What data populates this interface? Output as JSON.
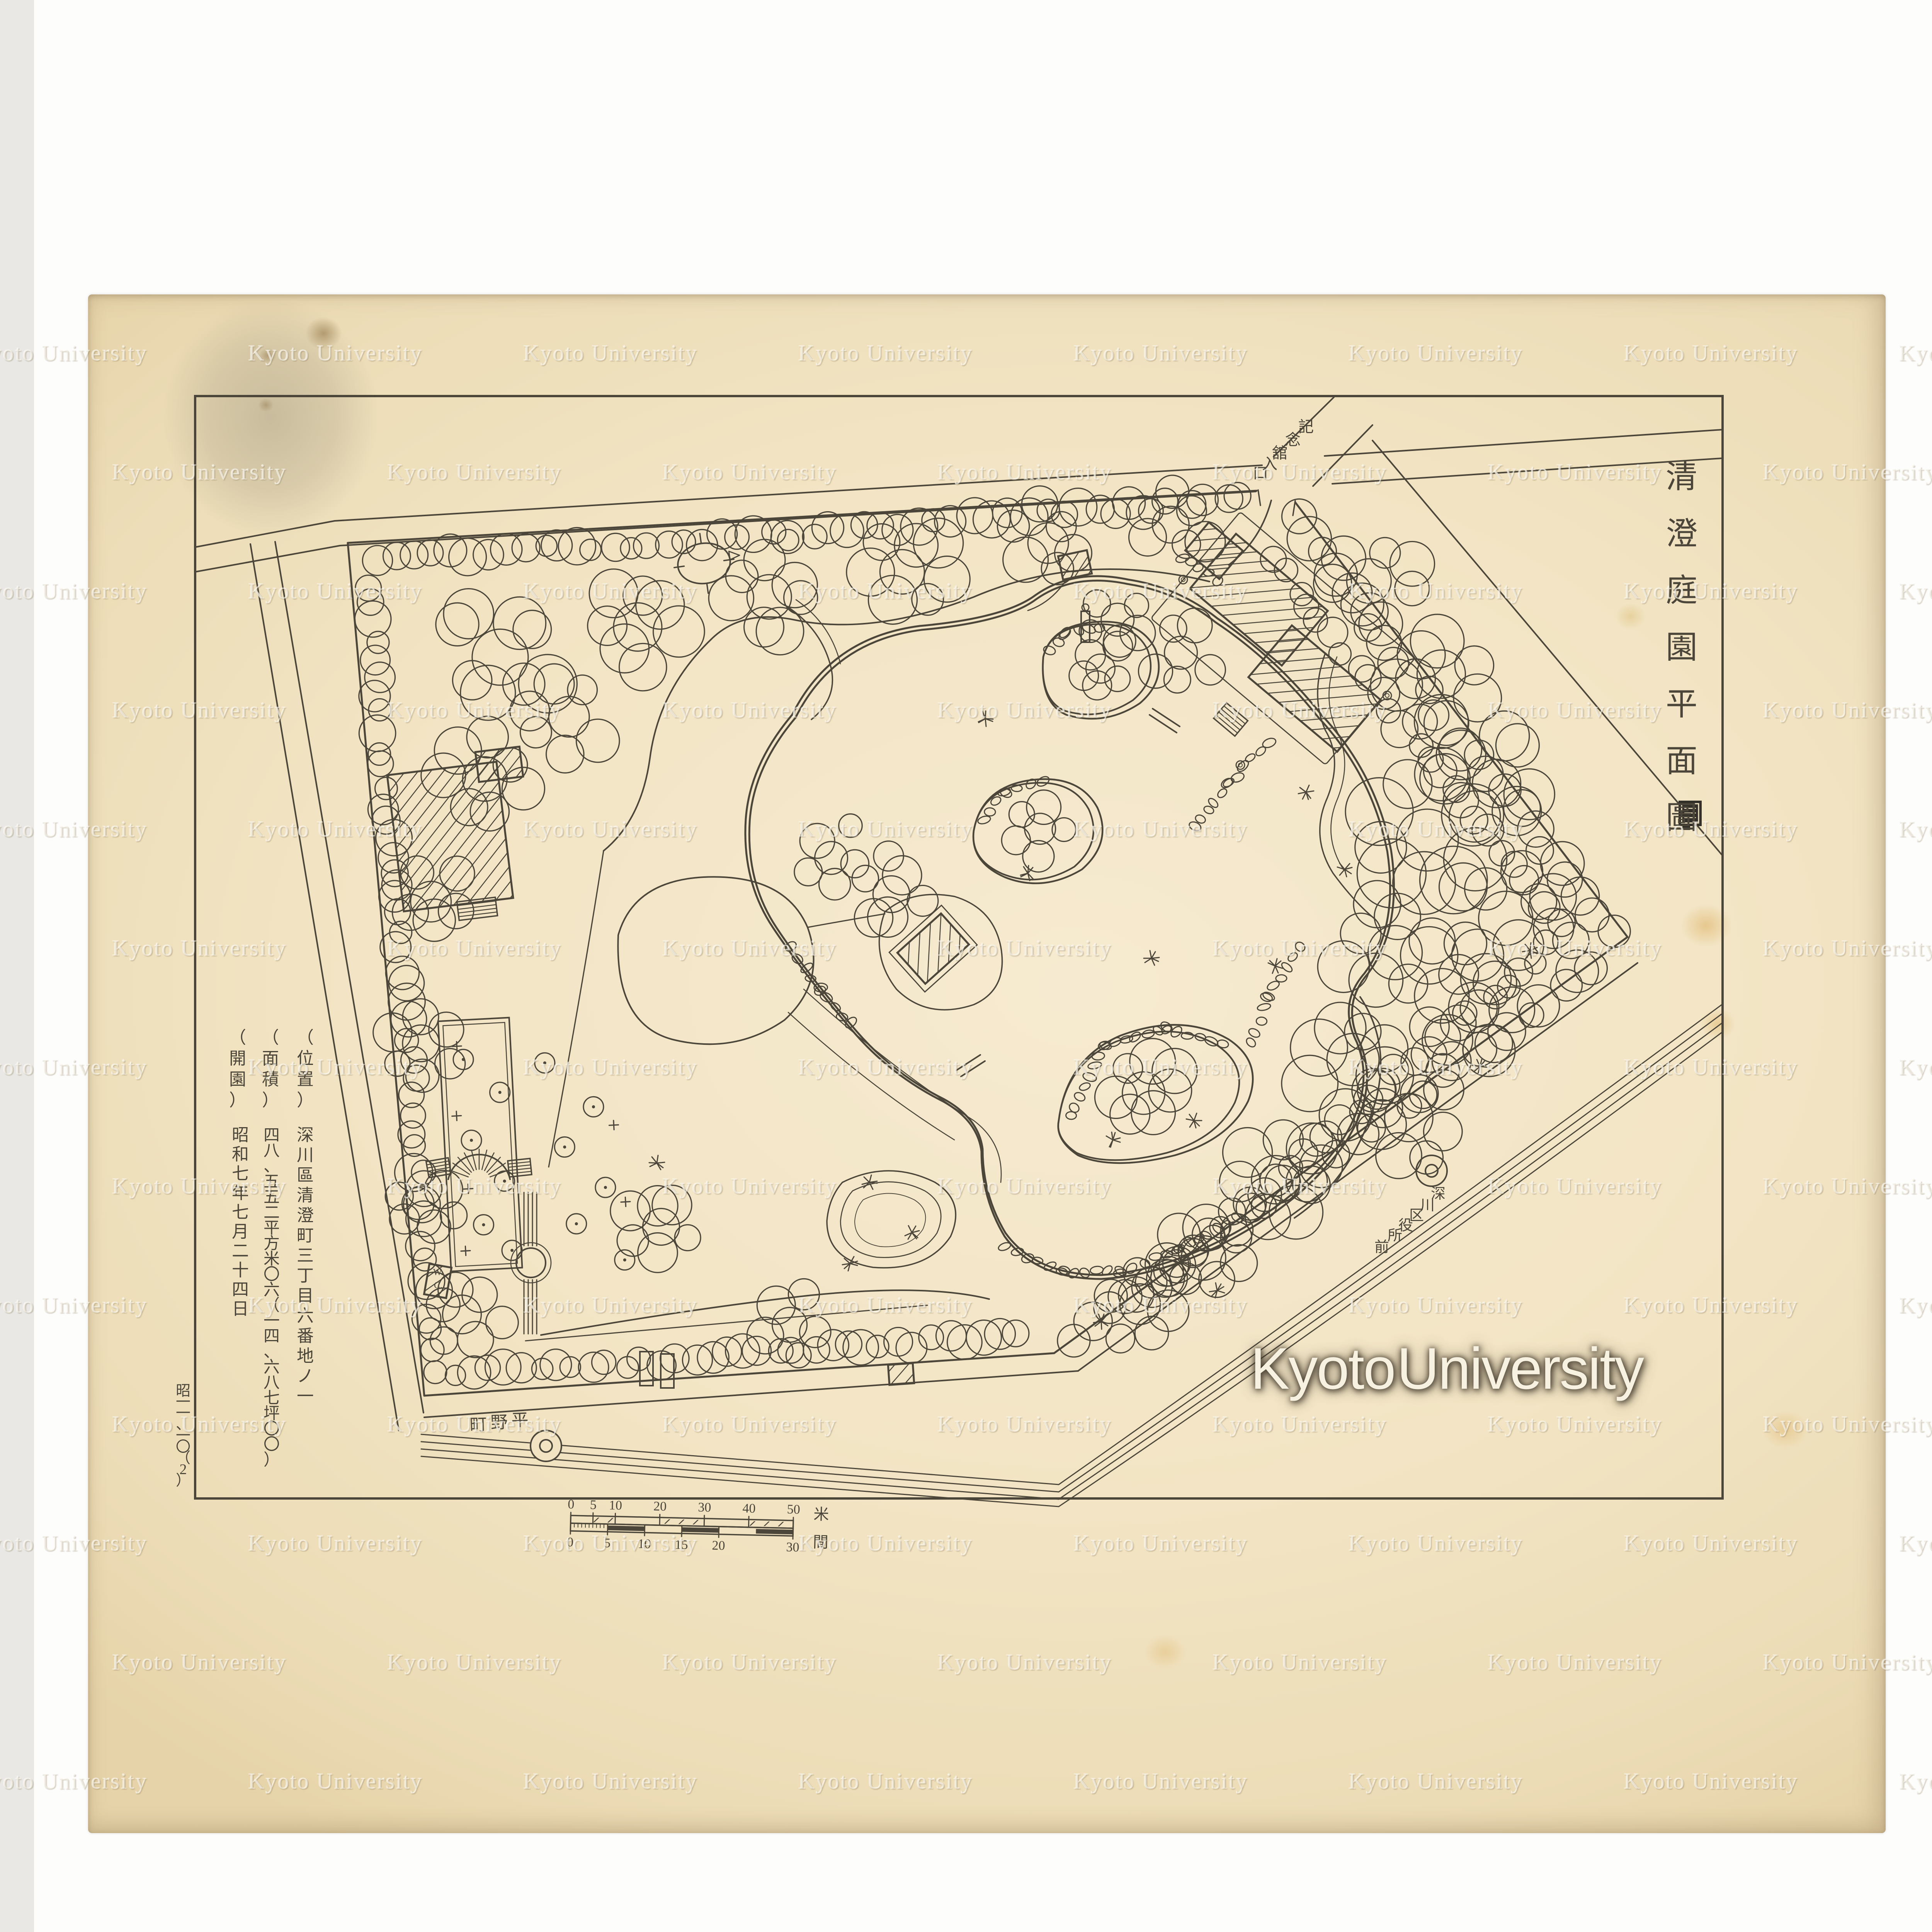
{
  "document": {
    "kind": "scanned-garden-plan",
    "title_vertical": "清澄庭園平面圖",
    "annotations": [
      {
        "label": "（位置）",
        "value": "深川區清澄町三丁目六番地ノ一"
      },
      {
        "label": "（面積）",
        "value": "四八、五五二平方米〇六（一四、六八七坪〇〇）"
      },
      {
        "label": "（開園）",
        "value": "昭和七年七月二十四日"
      }
    ],
    "corner_note": "昭一一、一〇（2）"
  },
  "map": {
    "labels": {
      "entrance": "記念舘入口",
      "street_bottom": "平野町",
      "street_bottom_display": "町野平",
      "street_right": "深川区役所前",
      "toilet": "W.C."
    },
    "scale_bar": {
      "meters": {
        "ticks": [
          "0",
          "5",
          "10",
          "20",
          "30",
          "40",
          "50"
        ],
        "unit": "米"
      },
      "ken": {
        "ticks": [
          "0",
          "5",
          "10",
          "15",
          "20",
          "30"
        ],
        "unit": "間"
      }
    }
  },
  "watermark": {
    "tile_text": "Kyoto University",
    "big_text": "Kyoto University"
  },
  "colors": {
    "paper": "#f2e4c3",
    "ink": "#4b4639",
    "stain_gray": "#8d8672",
    "stain_brown": "#8a6b3c",
    "stain_orange": "#d9a44a",
    "stamp": "#33302a",
    "watermark_big_fill": "#f7f1e1"
  }
}
